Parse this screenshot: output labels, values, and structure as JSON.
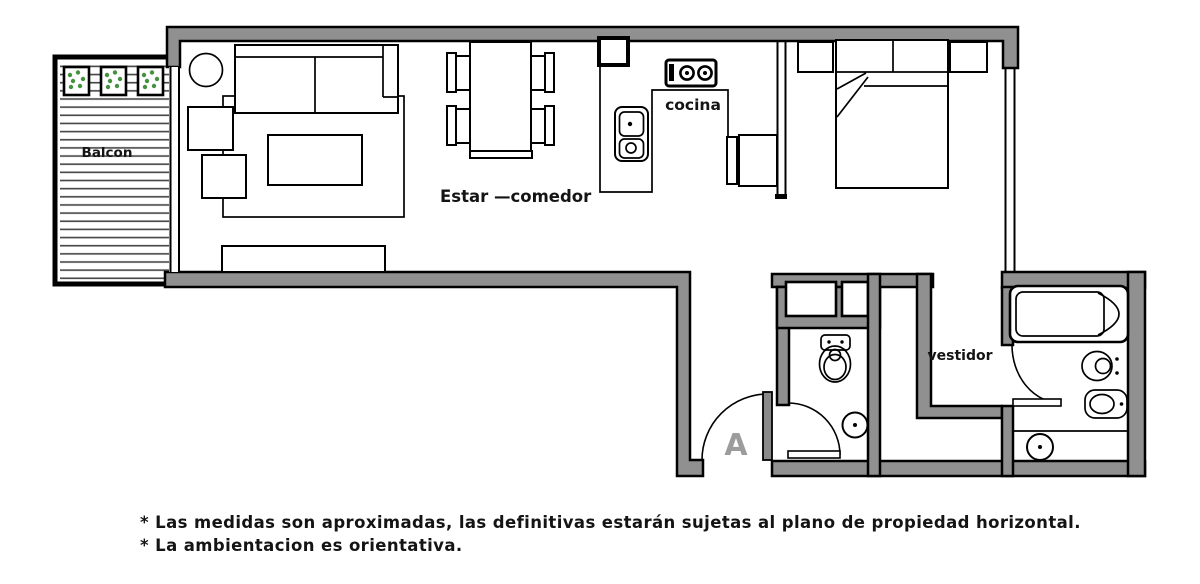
{
  "floor_plan": {
    "labels": {
      "balcony": "Balcon",
      "living_dining": "Estar —comedor",
      "kitchen": "cocina",
      "dressing_room": "vestidor",
      "entry_door": "A"
    },
    "footnotes": [
      "* Las medidas son aproximadas, las definitivas estarán sujetas al plano de propiedad horizontal.",
      "* La ambientacion es orientativa."
    ],
    "colors": {
      "wall_fill": "#909090",
      "line": "#000000",
      "deck_line": "#4a4a4a",
      "plant_dots": "#44913e",
      "door_label": "#9c9c9c",
      "background": "#ffffff"
    }
  }
}
